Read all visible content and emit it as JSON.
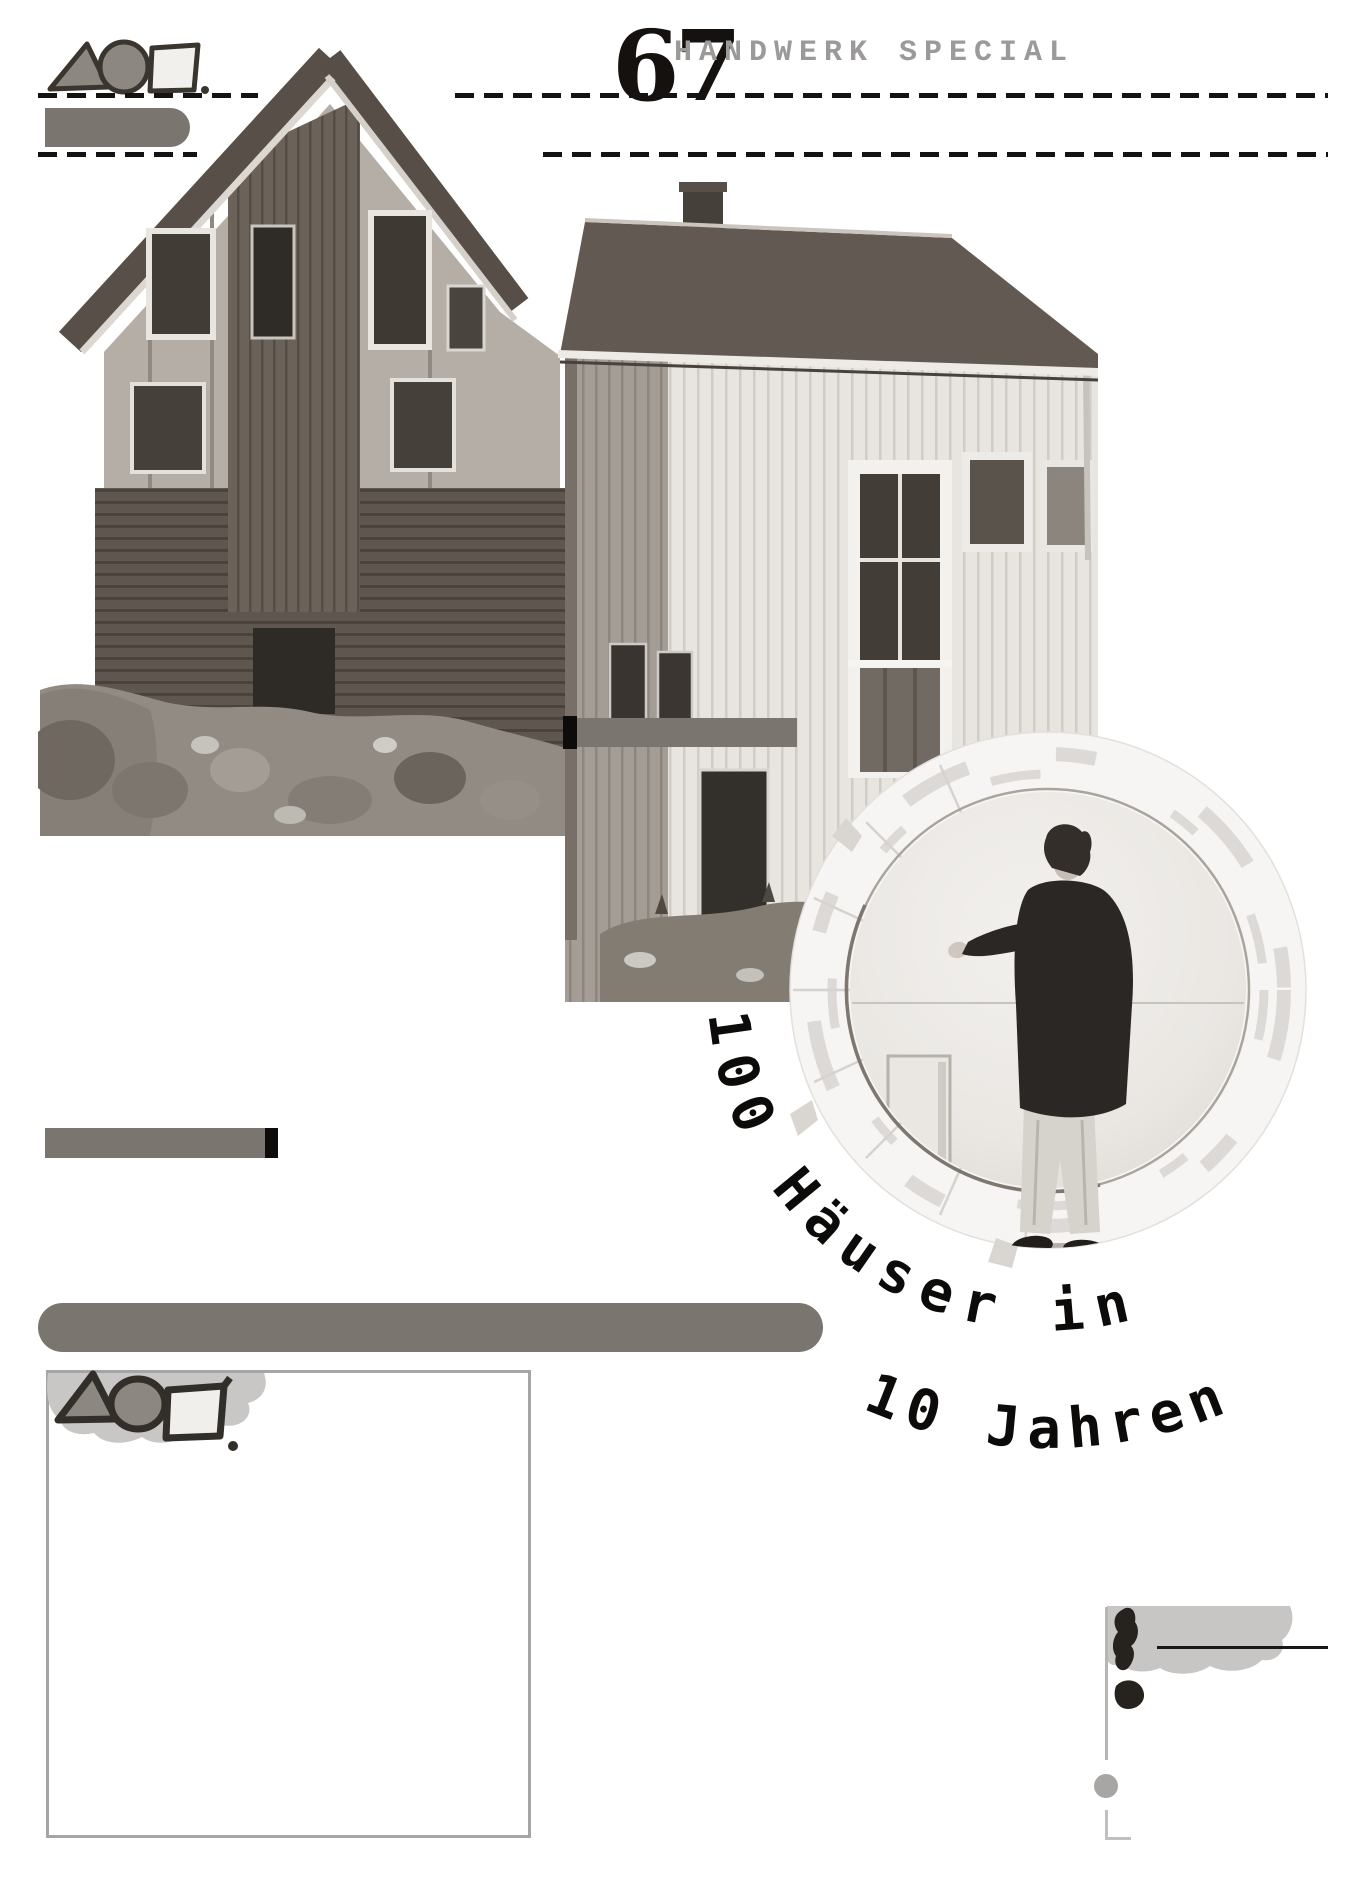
{
  "header": {
    "issue_number": "67",
    "magazine_title": "HANDWERK SPECIAL"
  },
  "hero": {
    "arc_text_line1": "100 Häuser in",
    "arc_text_line2": "10 Jahren"
  },
  "colors": {
    "bar_gray": "#7a756f",
    "dash_black": "#151311",
    "magazine_title_gray": "#9c9a98",
    "box_border_gray": "#a7a5a3",
    "ink_black": "#26221e",
    "blob_gray": "#c8c6c4",
    "photo_duotone_dark": "#574f48",
    "photo_duotone_light": "#e8e5e0"
  },
  "icons": {
    "logo_top": "triangle-circle-square-mark",
    "logo_box": "triangle-circle-square-mark",
    "exclamation": "hand-drawn-exclamation-icon"
  },
  "photos": {
    "house": "wooden-house-exterior-photo",
    "portrait": "man-standing-in-circular-model-photo"
  }
}
